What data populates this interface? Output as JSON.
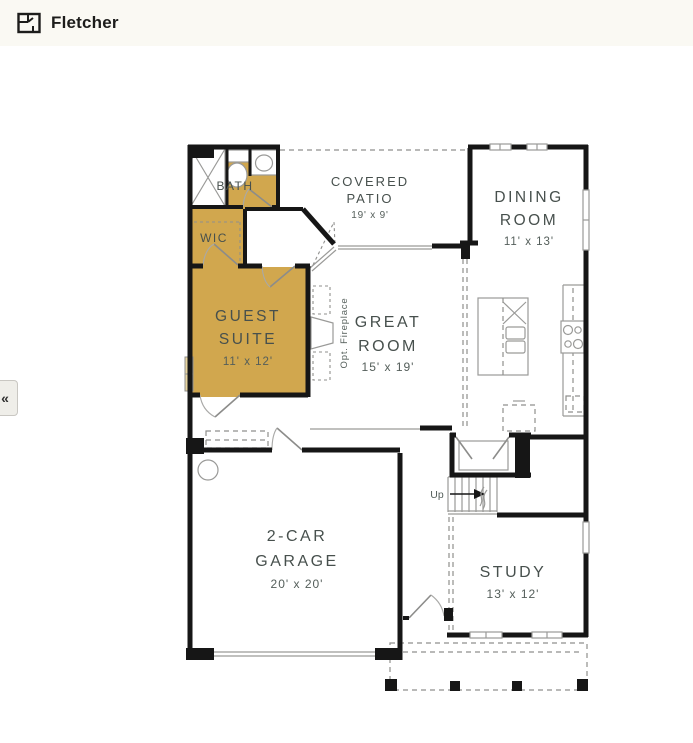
{
  "header": {
    "title": "Fletcher",
    "icon": "floorplan-icon"
  },
  "nav": {
    "collapse_glyph": "«"
  },
  "colors": {
    "highlight_gold": "#D1A74E",
    "highlight_window": "#E8D5A0",
    "wall": "#161616",
    "header_bg": "#FAF9F3",
    "plan_text": "#47504D"
  },
  "plan": {
    "bath": {
      "name": "BATH"
    },
    "wic": {
      "name": "WIC"
    },
    "guest_suite": {
      "line1": "GUEST",
      "line2": "SUITE",
      "dims": "11' x 12'"
    },
    "covered_patio": {
      "line1": "COVERED",
      "line2": "PATIO",
      "dims": "19' x 9'"
    },
    "great_room": {
      "line1": "GREAT",
      "line2": "ROOM",
      "dims": "15' x 19'"
    },
    "dining_room": {
      "line1": "DINING",
      "line2": "ROOM",
      "dims": "11' x 13'"
    },
    "garage": {
      "line1": "2-CAR",
      "line2": "GARAGE",
      "dims": "20' x 20'"
    },
    "study": {
      "name": "STUDY",
      "dims": "13' x 12'"
    },
    "fireplace_note": "Opt. Fireplace",
    "stairs_note": "Up"
  }
}
